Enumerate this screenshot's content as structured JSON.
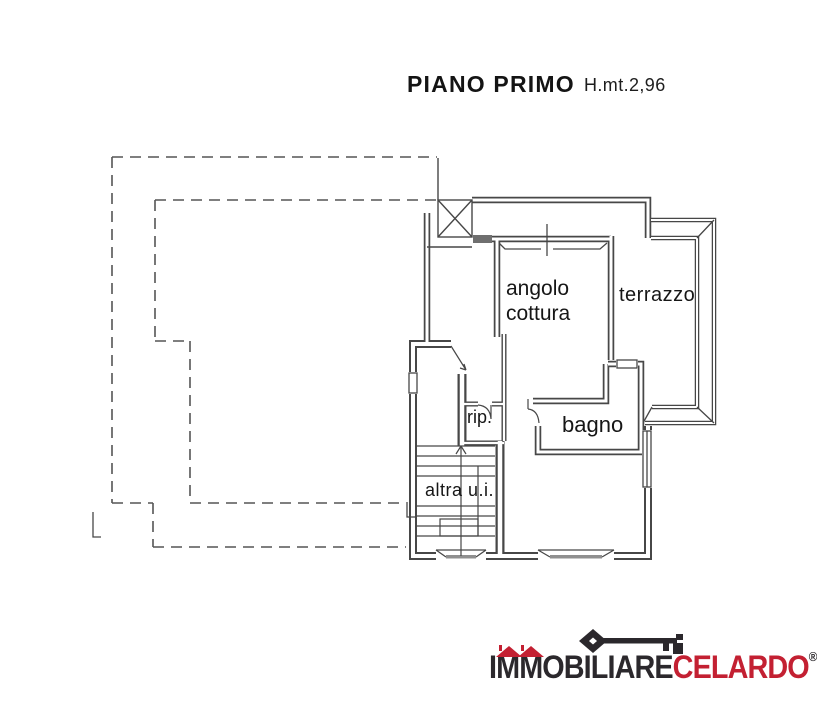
{
  "title": {
    "name": "PIANO PRIMO",
    "height": "H.mt.2,96"
  },
  "rooms": {
    "angolo_cottura": "angolo\ncottura",
    "terrazzo": "terrazzo",
    "rip": "rip.",
    "bagno": "bagno",
    "altra_ui": "altra u.i."
  },
  "logo": {
    "brand_primary": "IMMOBILIARE",
    "brand_secondary": "CELARDO",
    "registered_mark": "®",
    "key_icon": "skeleton-key-icon",
    "colors": {
      "primary_text": "#2b282c",
      "secondary_text": "#c32032",
      "roof_red": "#c32032"
    }
  },
  "plan": {
    "line_color": "#474747",
    "dash_color": "#555555",
    "sill_fill": "#8f8f8f"
  }
}
